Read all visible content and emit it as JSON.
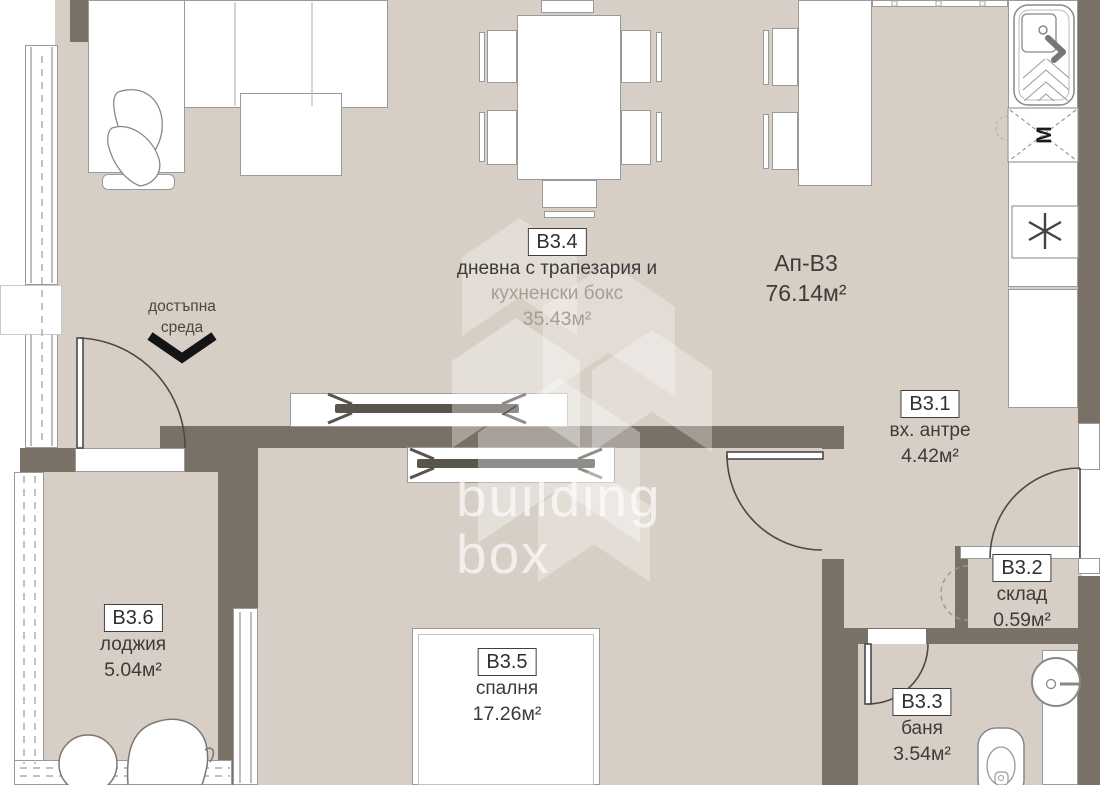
{
  "apartment": {
    "code": "Ап-В3",
    "area": "76.14м²"
  },
  "accessibility": {
    "line1": "достъпна",
    "line2": "среда"
  },
  "watermark": {
    "line1": "building",
    "line2": "box"
  },
  "rooms": {
    "living": {
      "code": "В3.4",
      "name1": "дневна с трапезария и",
      "name2": "кухненски бокс",
      "area": "35.43м²"
    },
    "entry": {
      "code": "В3.1",
      "name": "вх. антре",
      "area": "4.42м²"
    },
    "storage": {
      "code": "В3.2",
      "name": "склад",
      "area": "0.59м²"
    },
    "bath": {
      "code": "В3.3",
      "name": "баня",
      "area": "3.54м²"
    },
    "bedroom": {
      "code": "В3.5",
      "name": "спалня",
      "area": "17.26м²"
    },
    "loggia": {
      "code": "В3.6",
      "name": "лоджия",
      "area": "5.04м²"
    }
  },
  "appliances": {
    "washer_label": "М"
  },
  "colors": {
    "floor": "#d7cfc5",
    "wall": "#7a7166",
    "line": "#8a8a8a",
    "text": "#3b3b3b"
  }
}
